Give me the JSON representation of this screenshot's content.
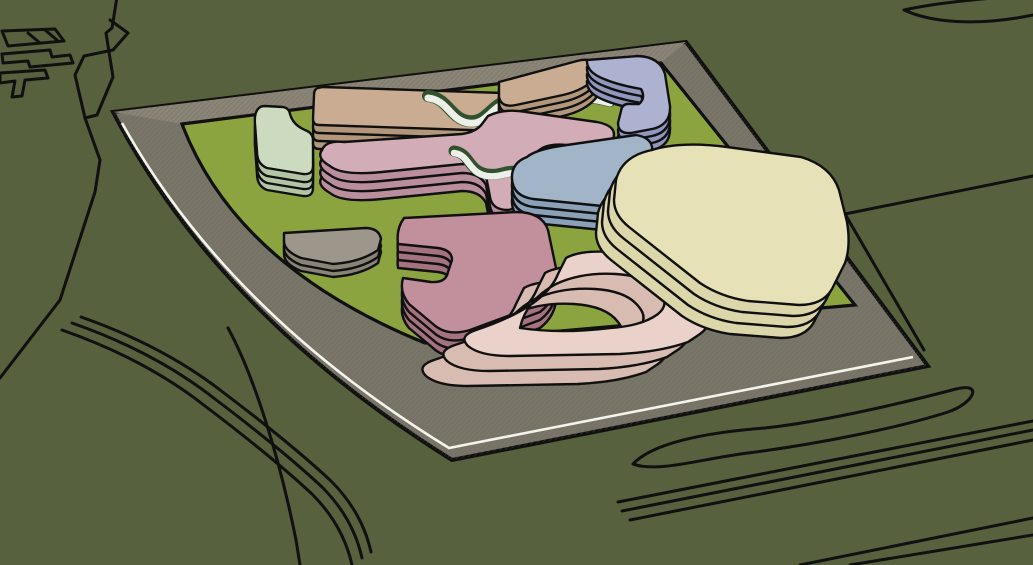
{
  "scene": {
    "description": "Aerial axonometric massing model: ten pastel building blocks on a lawn, wrapped by a hatched plaza deck and curved ring road, set on olive terrain with outlined parcels and roads.",
    "style": "sketchup-line-render",
    "view": "aerial-oblique"
  },
  "canvas": {
    "width": 1033,
    "height": 565
  },
  "colors": {
    "background": "#57613e",
    "outline": "#101010",
    "plaza": "#797568",
    "plaza_light_band": "#8b8577",
    "hatch": "#69655a",
    "curb_stripe": "#f4f3ec",
    "lawn": "#8ca440",
    "ribbon_green": "#32512e",
    "ribbon_white": "#ecf0e9"
  },
  "site": {
    "plaza_label": "paved plaza deck",
    "lawn_label": "campus lawn",
    "road_label": "perimeter ring road",
    "stripe_label": "white curb stripe"
  },
  "buildings": {
    "sage": {
      "label": "sage corner block",
      "top": "#ccdabf",
      "side": "#b2c6a6"
    },
    "tan_west": {
      "label": "tan bar west",
      "top": "#c9ac92",
      "side": "#b2977c"
    },
    "tan_east": {
      "label": "tan bar east",
      "top": "#c9ac92",
      "side": "#b2977c"
    },
    "periwinkle": {
      "label": "periwinkle hook block",
      "top": "#adb2d0",
      "side": "#9298bd"
    },
    "mauve": {
      "label": "mauve meander block",
      "top": "#d2acb7",
      "side": "#bb8e9d"
    },
    "bluegray": {
      "label": "blue-gray bar",
      "top": "#a2b5c8",
      "side": "#8aa1b7"
    },
    "gray_wedge": {
      "label": "gray wedge pavilion",
      "top": "#9c968b",
      "side": "#8a8478"
    },
    "rose": {
      "label": "rose notched block",
      "top": "#c28f9c",
      "side": "#a5737f"
    },
    "pink_loop": {
      "label": "pink loop slab",
      "top": "#ead2ca",
      "side": "#d9bcb1"
    },
    "cream": {
      "label": "cream terraced block",
      "top": "#e7e1b8",
      "side": "#dcd6ab"
    }
  }
}
